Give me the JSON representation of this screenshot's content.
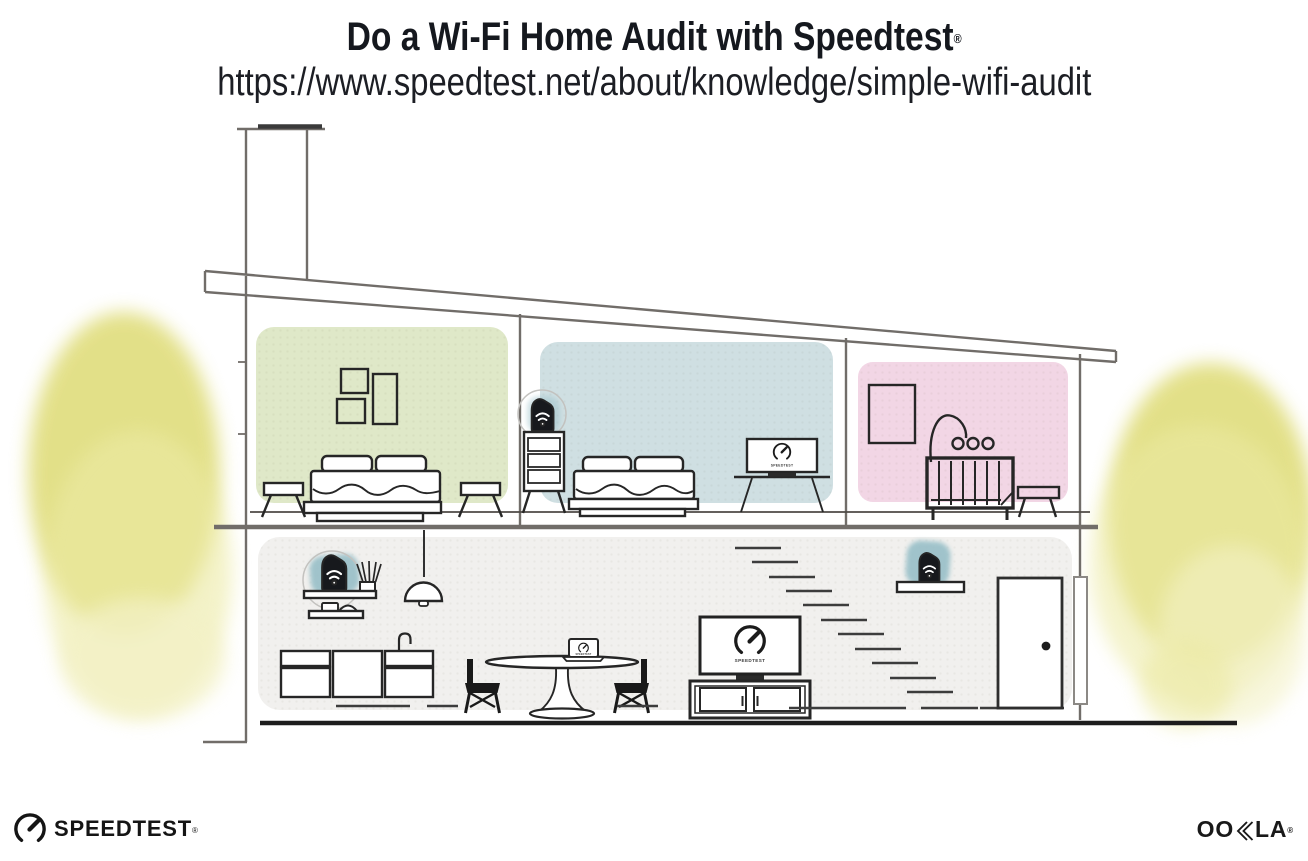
{
  "header": {
    "title": "Do a Wi-Fi Home Audit with Speedtest",
    "registered_mark": "®",
    "url": "https://www.speedtest.net/about/knowledge/simple-wifi-audit"
  },
  "illustration": {
    "screens": {
      "bedroom_monitor_label": "SPEEDTEST",
      "living_room_tv_label": "SPEEDTEST",
      "laptop_label": "SPEEDTEST"
    },
    "icons": {
      "wifi_device": "wifi-router-icon",
      "speedtest_gauge": "speedtest-gauge-icon"
    }
  },
  "footer": {
    "speedtest_wordmark": "SPEEDTEST",
    "speedtest_registered": "®",
    "ookla_left": "OO",
    "ookla_right": "LA",
    "ookla_registered": "®"
  },
  "colors": {
    "ink": "#262626",
    "line-dark": "#3c3c3c",
    "structure": "#716d69",
    "green-room": "#dfe8c8",
    "blue-room": "#cfdfe2",
    "pink-room": "#f2d6e5",
    "floor-gray": "#f1f0ee",
    "tree-yellow": "#dfdc78",
    "tree-light": "#eceaa4",
    "tree-wash": "#f3f1c6",
    "teal": "#98bfc8",
    "device-black": "#17191d",
    "text-dark": "#15181e"
  }
}
